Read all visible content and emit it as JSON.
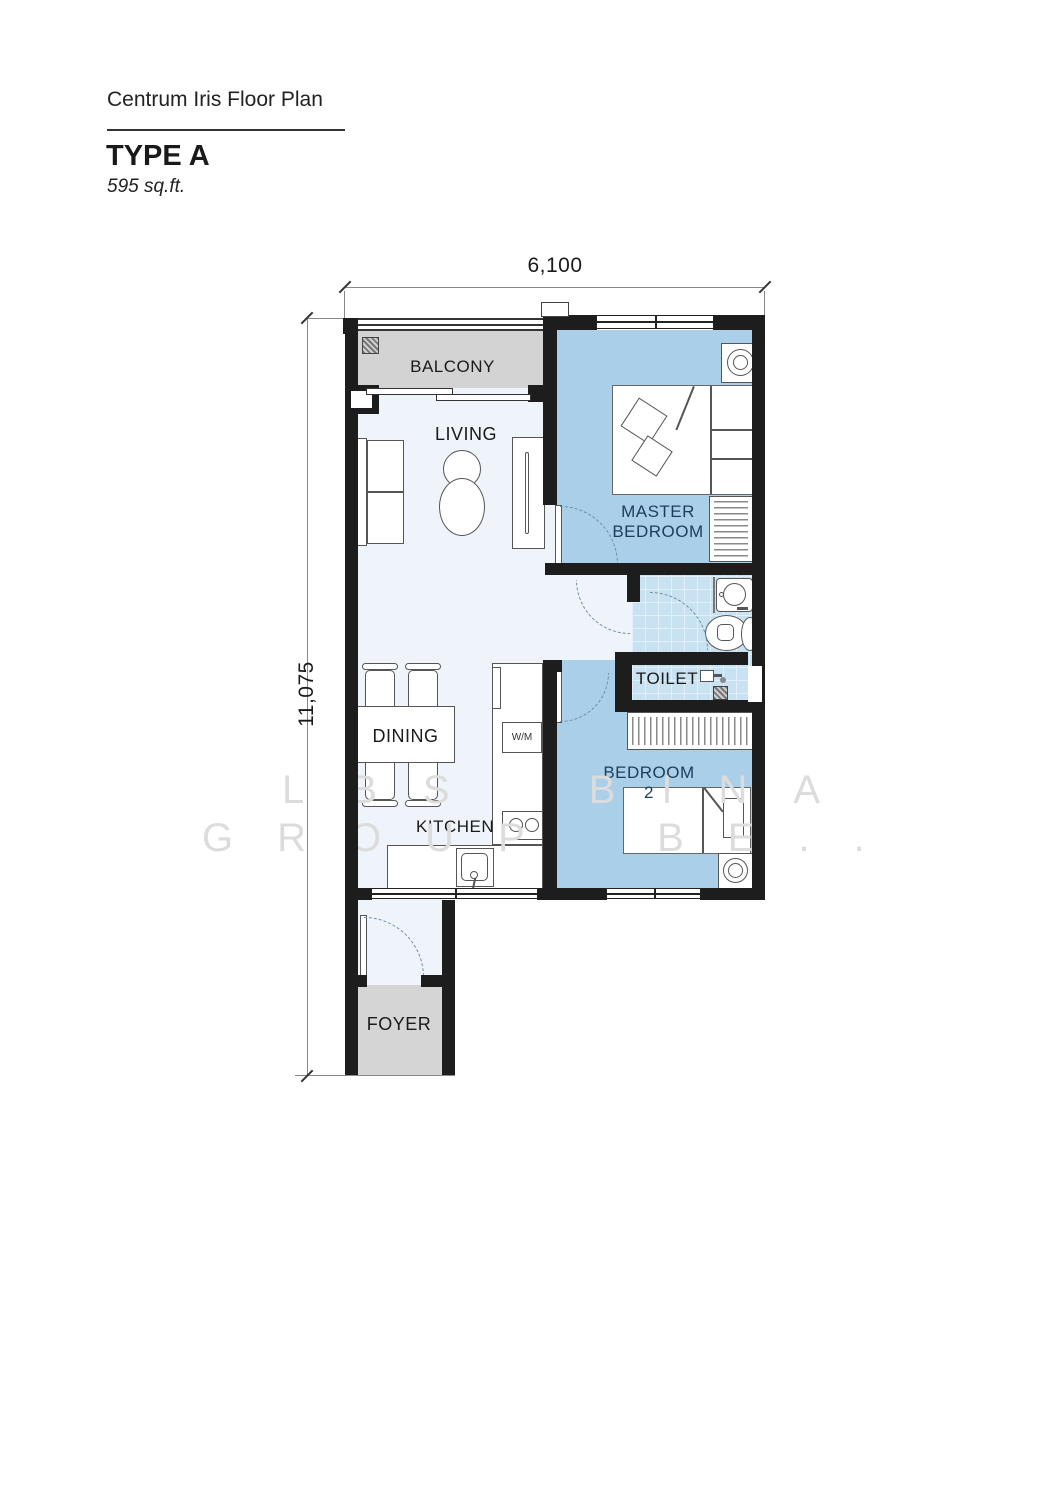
{
  "title_block": {
    "project_title": "Centrum Iris Floor Plan",
    "unit_type": "TYPE A",
    "unit_area": "595 sq.ft."
  },
  "dimensions": {
    "overall_width": "6,100",
    "overall_depth": "11,075"
  },
  "room_labels": {
    "balcony": "BALCONY",
    "living": "LIVING",
    "master_bedroom_line1": "MASTER",
    "master_bedroom_line2": "BEDROOM",
    "toilet": "TOILET",
    "dining": "DINING",
    "kitchen": "KITCHEN",
    "bedroom2": "BEDROOM 2",
    "foyer": "FOYER"
  },
  "fixture_labels": {
    "washing_machine": "W/M"
  },
  "watermark": {
    "line1": "LBS BINA",
    "line2": "GROUP BE.."
  },
  "colors": {
    "wall": "#1d1d1d",
    "bedroom_floor": "#a9cfe9",
    "tile_floor": "#c8e2f2",
    "living_floor": "#eef4f9",
    "balcony_floor": "#d3d3d3",
    "foyer_floor": "#d5d5d5",
    "room_label_navy": "#1e3c5e",
    "door_arc": "#6f8ca6",
    "watermark_gray": "#dcdcdc"
  }
}
